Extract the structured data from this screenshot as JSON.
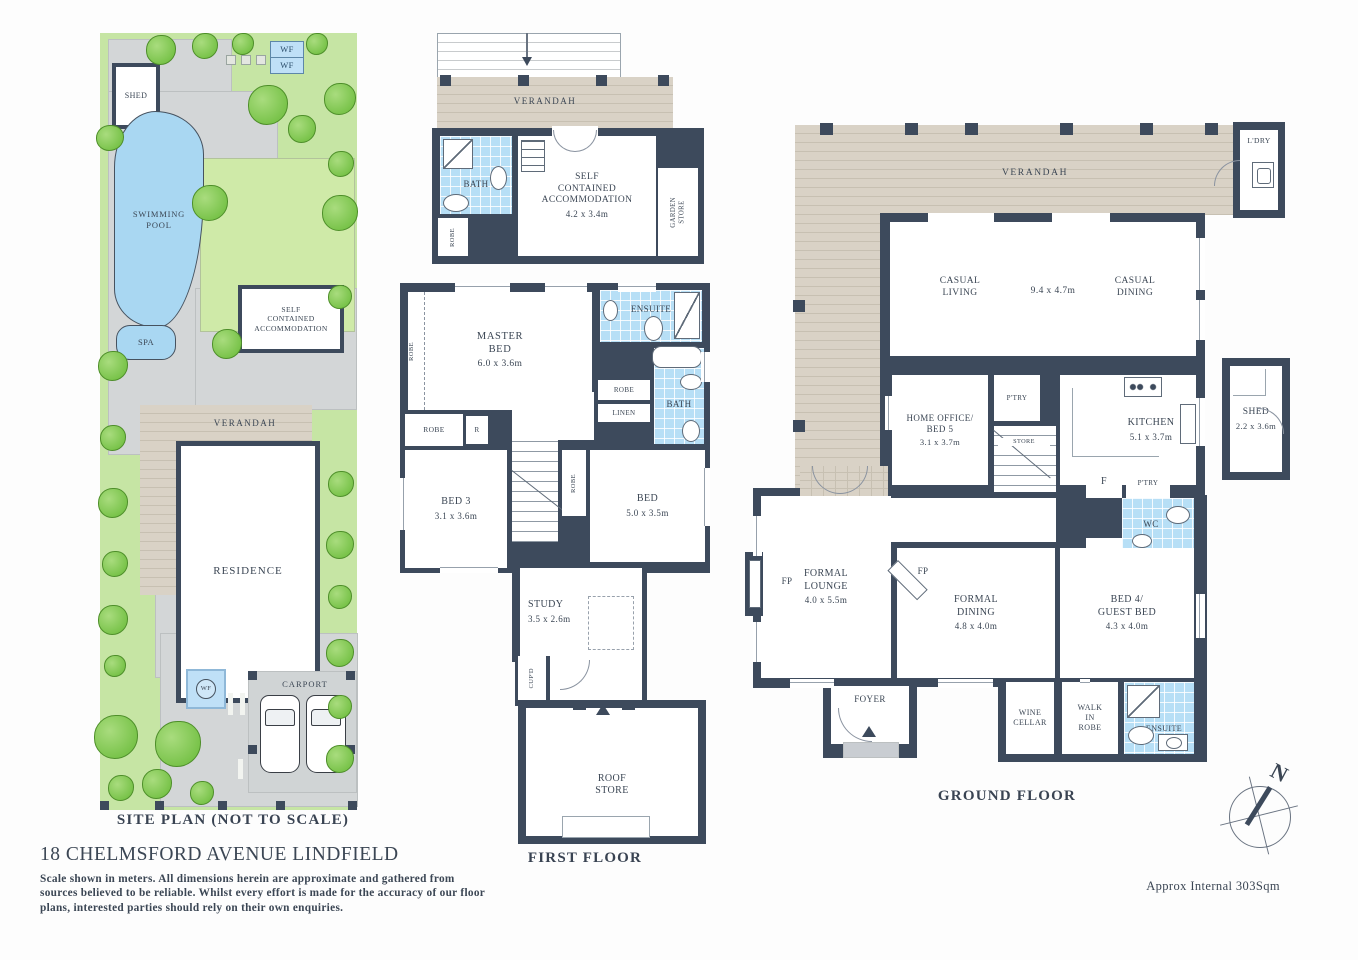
{
  "site_plan": {
    "title": "SITE PLAN (NOT TO SCALE)",
    "shed": "SHED",
    "wf1": "WF",
    "wf2": "WF",
    "wf3": "WF",
    "swimming_pool": "SWIMMING\nPOOL",
    "spa": "SPA",
    "self_contained": "SELF\nCONTAINED\nACCOMMODATION",
    "verandah": "VERANDAH",
    "residence": "RESIDENCE",
    "carport": "CARPORT"
  },
  "first_floor": {
    "title": "FIRST FLOOR",
    "verandah": "VERANDAH",
    "bath_upper": "BATH",
    "sca": {
      "name": "SELF\nCONTAINED\nACCOMMODATION",
      "dims": "4.2 x 3.4m"
    },
    "garden_store": "GARDEN\nSTORE",
    "robe_sca": "ROBE",
    "master": {
      "name": "MASTER\nBED",
      "dims": "6.0 x 3.6m"
    },
    "robe_master": "ROBE",
    "ensuite": "ENSUITE",
    "robe_hall": "ROBE",
    "linen": "LINEN",
    "bath": "BATH",
    "robe_bed3": "ROBE",
    "r": "R",
    "bed3": {
      "name": "BED 3",
      "dims": "3.1 x 3.6m"
    },
    "robe_stairs": "ROBE",
    "bed": {
      "name": "BED",
      "dims": "5.0 x 3.5m"
    },
    "study": {
      "name": "STUDY",
      "dims": "3.5 x 2.6m"
    },
    "cupd": "CUP'D",
    "roof_store": "ROOF\nSTORE"
  },
  "ground_floor": {
    "title": "GROUND FLOOR",
    "verandah": "VERANDAH",
    "ldry": "L'DRY",
    "casual_living": "CASUAL\nLIVING",
    "casual_dims": "9.4 x 4.7m",
    "casual_dining": "CASUAL\nDINING",
    "home_office": {
      "name": "HOME OFFICE/\nBED 5",
      "dims": "3.1 x 3.7m"
    },
    "ptry1": "P'TRY",
    "store": "STORE",
    "kitchen": {
      "name": "KITCHEN",
      "dims": "5.1 x 3.7m"
    },
    "fridge": "F",
    "ptry2": "P'TRY",
    "wc": "WC",
    "linen": "LINEN",
    "shed": {
      "name": "SHED",
      "dims": "2.2 x 3.6m"
    },
    "formal_lounge": {
      "name": "FORMAL\nLOUNGE",
      "dims": "4.0 x 5.5m"
    },
    "fp_lounge": "FP",
    "fp_dining": "FP",
    "formal_dining": {
      "name": "FORMAL\nDINING",
      "dims": "4.8 x 4.0m"
    },
    "bed4": {
      "name": "BED 4/\nGUEST BED",
      "dims": "4.3 x 4.0m"
    },
    "foyer": "FOYER",
    "wine_cellar": "WINE\nCELLAR",
    "walk_in_robe": "WALK\nIN\nROBE",
    "ensuite": "ENSUITE"
  },
  "footer": {
    "address": "18 CHELMSFORD AVENUE LINDFIELD",
    "disclaimer": "Scale shown in meters. All dimensions herein are approximate and gathered from\nsources believed to be reliable. Whilst every effort is made for the accuracy of our floor\nplans, interested parties should rely on their own enquiries.",
    "approx_internal": "Approx Internal 303Sqm",
    "compass_north": "N"
  }
}
